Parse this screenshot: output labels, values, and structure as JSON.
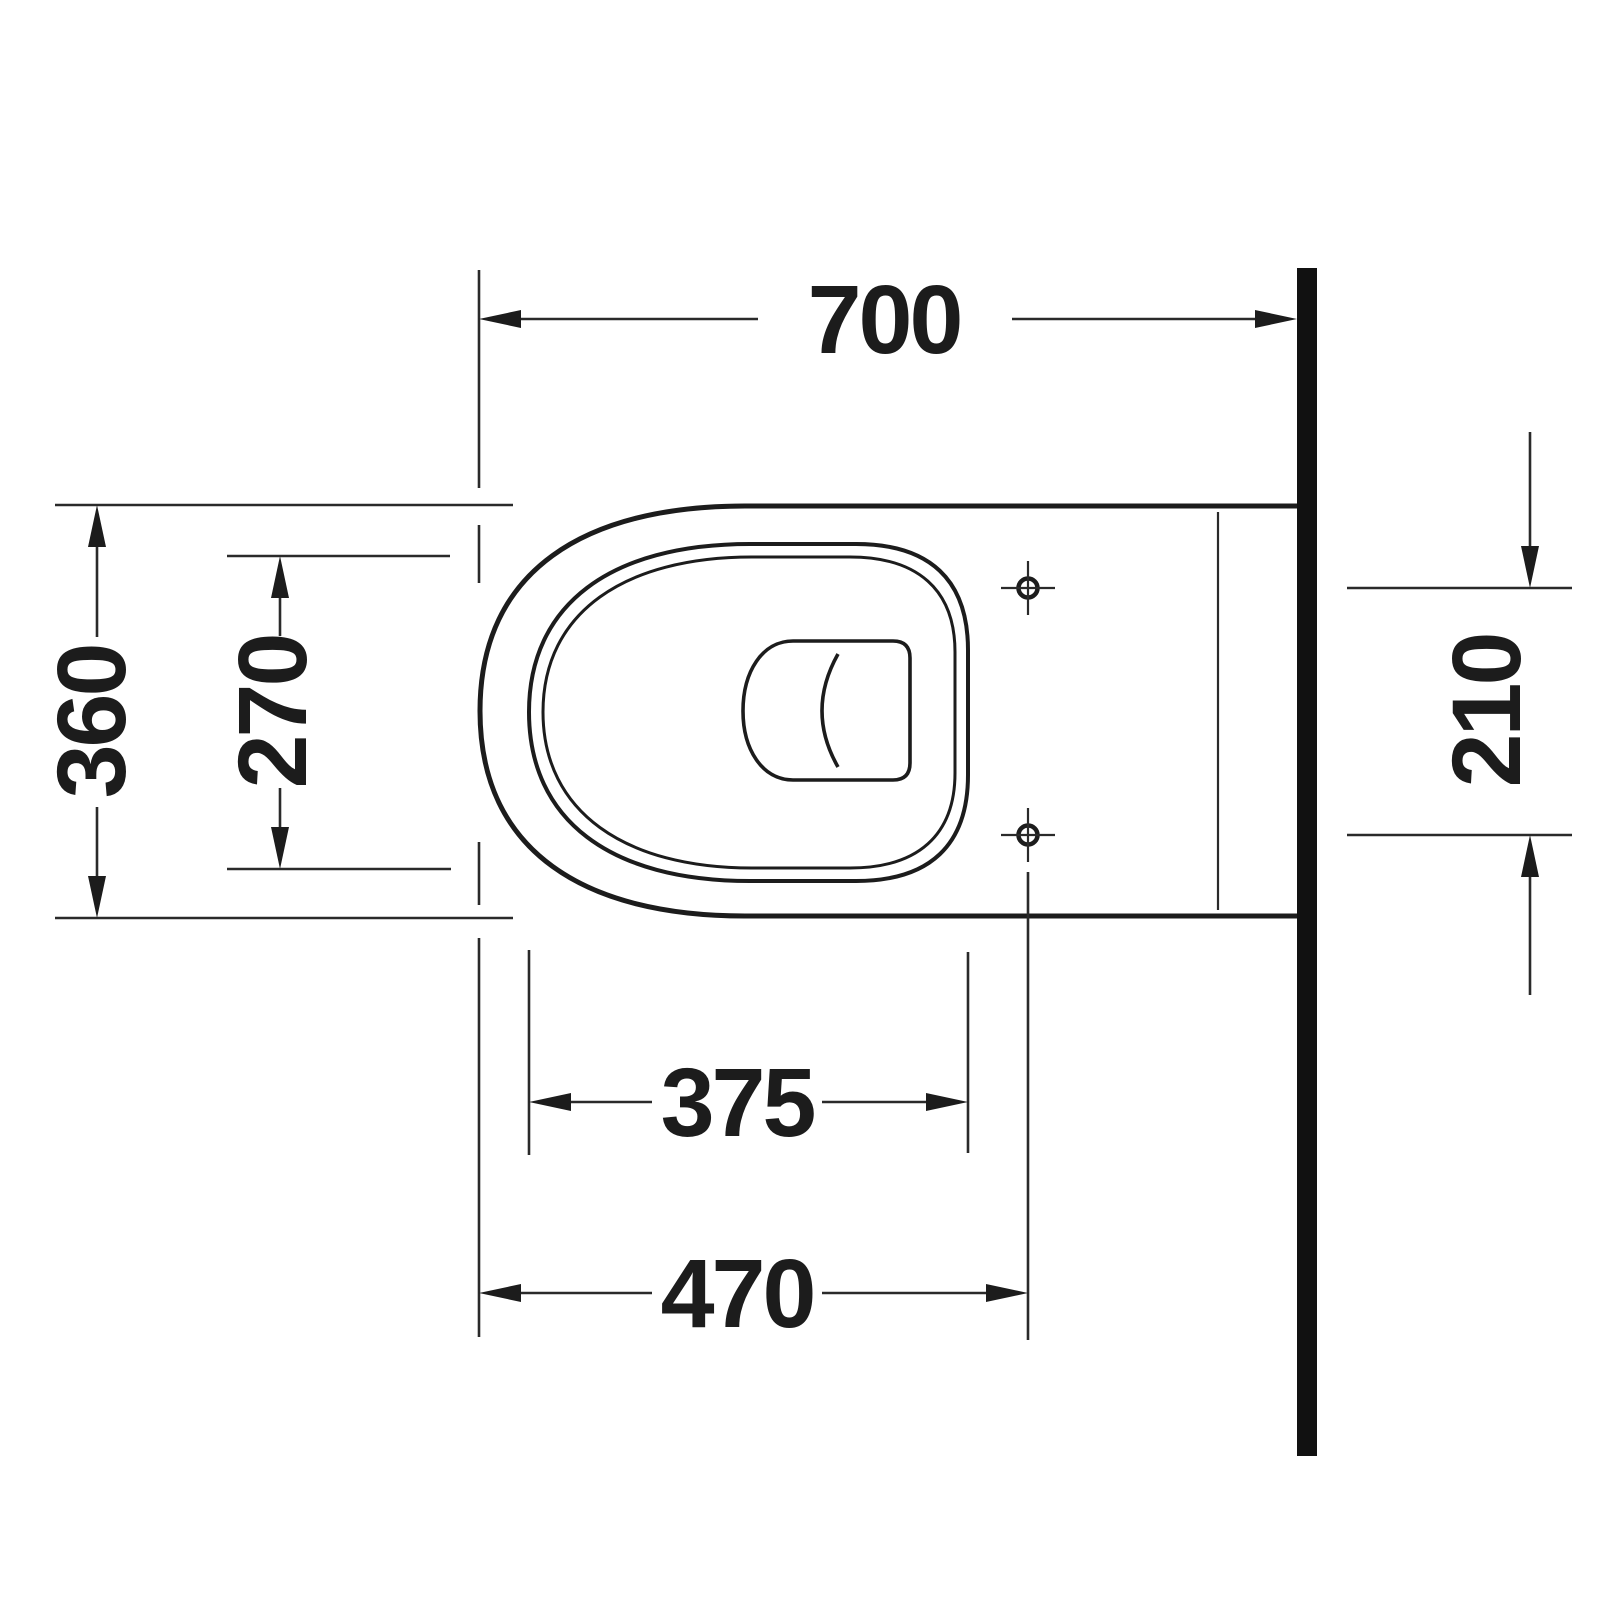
{
  "title": "Wall-hung toilet top-view installation drawing",
  "colors": {
    "line": "#1c1c1c",
    "background": "#ffffff",
    "wall_fill": "#111111"
  },
  "dimensions": {
    "overall_length_mm": "700",
    "overall_width_mm": "360",
    "bowl_opening_width_mm": "270",
    "fixing_hole_spacing_mm": "210",
    "seat_rim_length_mm": "375",
    "front_to_fixing_holes_mm": "470"
  }
}
